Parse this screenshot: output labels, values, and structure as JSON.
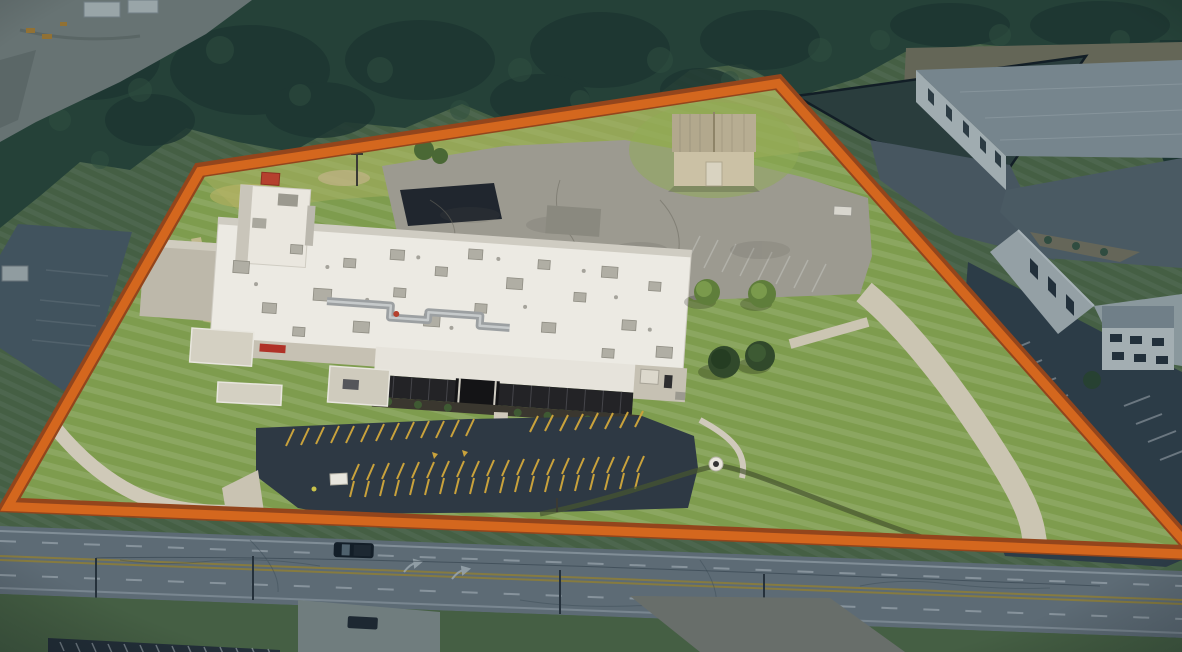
{
  "scene": {
    "type": "aerial-drone-photograph",
    "subject": "Aerial view of an industrial facility parcel outlined with an orange property boundary",
    "boundary": {
      "points_str": "200,170 778,82 1196,553 8,505",
      "stroke_color": "#D4671E",
      "edge_color": "#93451C",
      "stroke_width_px": 14
    },
    "colors": {
      "grass_inside": "#7E9C4E",
      "grass_berm": "#A6AE5F",
      "grass_outside": "#5C7546",
      "trees": "#2E4A34",
      "trees_dark": "#22382A",
      "roof_white": "#ECEAE3",
      "wall_tan": "#C6C1B3",
      "rear_lot_concrete": "#9C9A90",
      "repave_patch": "#20262E",
      "front_lot_asphalt": "#2E3944",
      "parking_stripe_yellow": "#C9A23C",
      "road_asphalt": "#7E868C",
      "road_line_yellow": "#B99C3F",
      "road_line_white": "#C9CED1",
      "neighbor_warehouse_roof": "#A2ABAE",
      "neighbor_warehouse_wall": "#DFE2E0",
      "shed_wall": "#CBC1A5",
      "shed_roof": "#B7AD92",
      "concrete_drive": "#CBC5B2",
      "red_rooftop_unit": "#B5402E",
      "red_wall_sign": "#B03228",
      "dim_overlay": "#123043"
    },
    "vehicles": {
      "pickup_truck_on_road": 1,
      "car_in_south_lot": 1
    }
  }
}
